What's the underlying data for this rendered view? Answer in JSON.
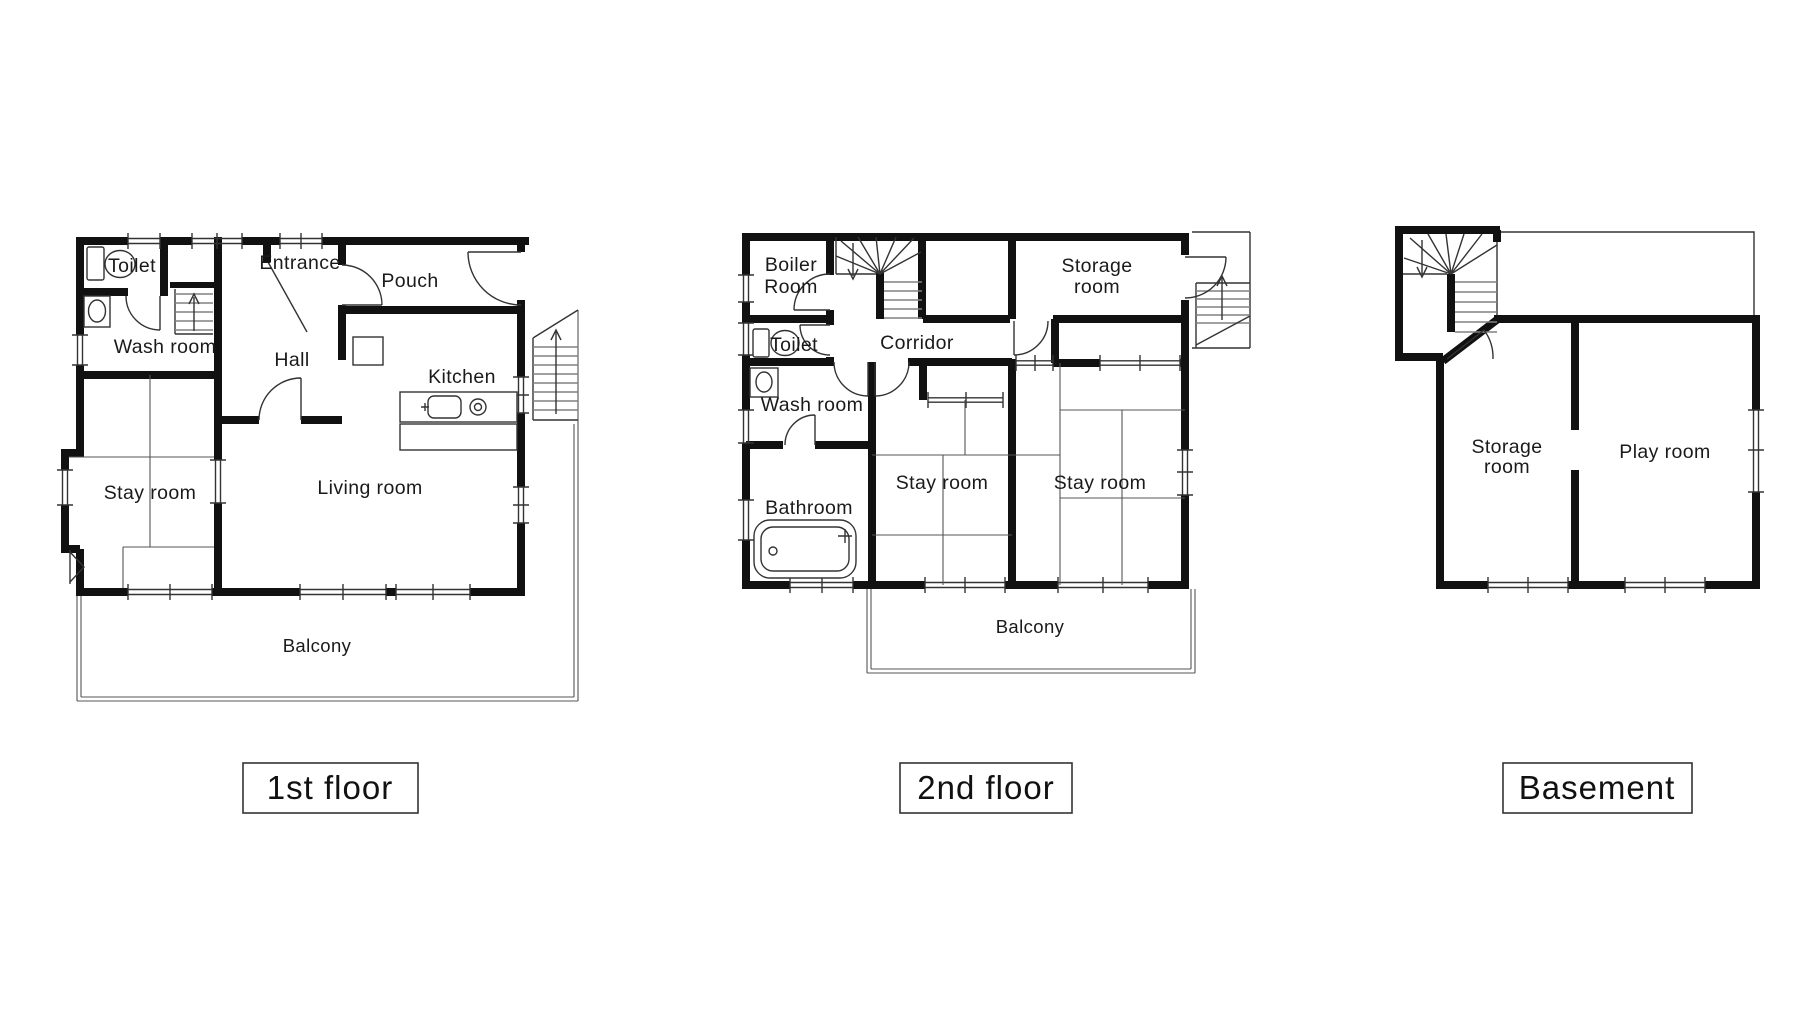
{
  "figure": {
    "type": "floor-plan-set",
    "background_color": "#ffffff",
    "wall_color": "#111111"
  },
  "floors": {
    "first": {
      "title": "1st floor",
      "rooms": {
        "toilet": "Toilet",
        "wash_room": "Wash room",
        "entrance": "Entrance",
        "hall": "Hall",
        "pouch": "Pouch",
        "kitchen": "Kitchen",
        "living_room": "Living room",
        "stay_room": "Stay room",
        "balcony": "Balcony"
      }
    },
    "second": {
      "title": "2nd floor",
      "rooms": {
        "boiler": {
          "line1": "Boiler",
          "line2": "Room"
        },
        "toilet": "Toilet",
        "corridor": "Corridor",
        "wash_room": "Wash room",
        "bathroom": "Bathroom",
        "stay_room_left": "Stay room",
        "stay_room_right": "Stay room",
        "storage": {
          "line1": "Storage",
          "line2": "room"
        },
        "balcony": "Balcony"
      }
    },
    "basement": {
      "title": "Basement",
      "rooms": {
        "storage": {
          "line1": "Storage",
          "line2": "room"
        },
        "play_room": "Play room"
      }
    }
  }
}
